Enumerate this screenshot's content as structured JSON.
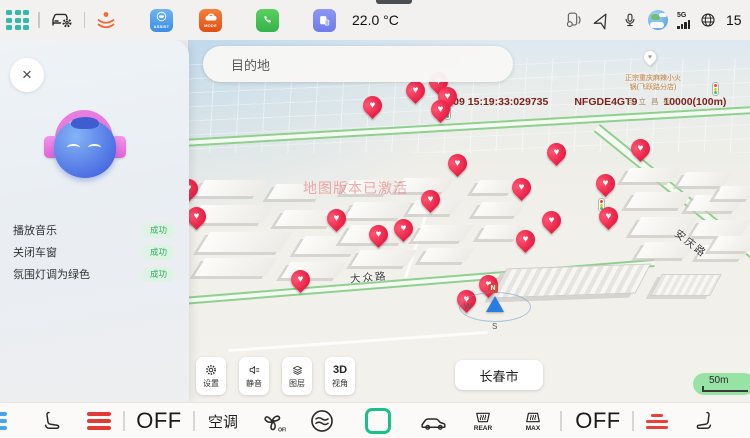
{
  "status_bar": {
    "temperature": "22.0 °C",
    "network": "5G",
    "time": "15",
    "icons": [
      "app-grid",
      "car-settings",
      "seat-massage",
      "assist-app",
      "mode-app",
      "phone-app",
      "tablet-app",
      "device-volume",
      "navigation",
      "microphone",
      "weather",
      "signal",
      "globe"
    ],
    "assist_label": "ASSIST",
    "mode_label": "MODE"
  },
  "assistant": {
    "close_glyph": "×",
    "commands": [
      {
        "text": "播放音乐",
        "status": "成功"
      },
      {
        "text": "关闭车窗",
        "status": "成功"
      },
      {
        "text": "氛围灯调为绿色",
        "status": "成功"
      }
    ]
  },
  "map": {
    "search_placeholder": "目的地",
    "debug": {
      "time": "12-09 15:19:33:029735",
      "code": "NFGDE4GT9",
      "range": "10000(100m)"
    },
    "watermark": "地图版本已激活",
    "road_dz": "大众路",
    "road_aq": "安庆路",
    "street": "自立昌街",
    "poi": {
      "line1": "正宗重庆麻辣小火",
      "line2": "锅(飞跃路分店)",
      "glyph": "♥"
    },
    "compass": {
      "n": "N",
      "w": "W",
      "s": "S"
    },
    "controls": [
      {
        "label": "设置"
      },
      {
        "label": "静音"
      },
      {
        "label": "图层"
      },
      {
        "icon_text": "3D",
        "label": "视角"
      }
    ],
    "city_button": "长春市",
    "scale_label": "50m",
    "pin_glyph": "♥",
    "pins": [
      {
        "x": 184,
        "y": 65
      },
      {
        "x": 227,
        "y": 50
      },
      {
        "x": 250,
        "y": 41
      },
      {
        "x": 259,
        "y": 56
      },
      {
        "x": 252,
        "y": 69
      },
      {
        "x": 0,
        "y": 148
      },
      {
        "x": 8,
        "y": 176
      },
      {
        "x": 148,
        "y": 178
      },
      {
        "x": 190,
        "y": 194
      },
      {
        "x": 215,
        "y": 188
      },
      {
        "x": 242,
        "y": 159
      },
      {
        "x": 269,
        "y": 123
      },
      {
        "x": 333,
        "y": 147
      },
      {
        "x": 337,
        "y": 199
      },
      {
        "x": 363,
        "y": 180
      },
      {
        "x": 368,
        "y": 112
      },
      {
        "x": 417,
        "y": 143
      },
      {
        "x": 420,
        "y": 176
      },
      {
        "x": 452,
        "y": 108
      },
      {
        "x": 112,
        "y": 239
      },
      {
        "x": 278,
        "y": 259
      },
      {
        "x": 300,
        "y": 244
      }
    ]
  },
  "bottom_bar": {
    "off_left": "OFF",
    "ac_label": "空调",
    "fan_off": "OFF",
    "rear_label": "REAR",
    "max_label": "MAX",
    "off_right": "OFF"
  }
}
